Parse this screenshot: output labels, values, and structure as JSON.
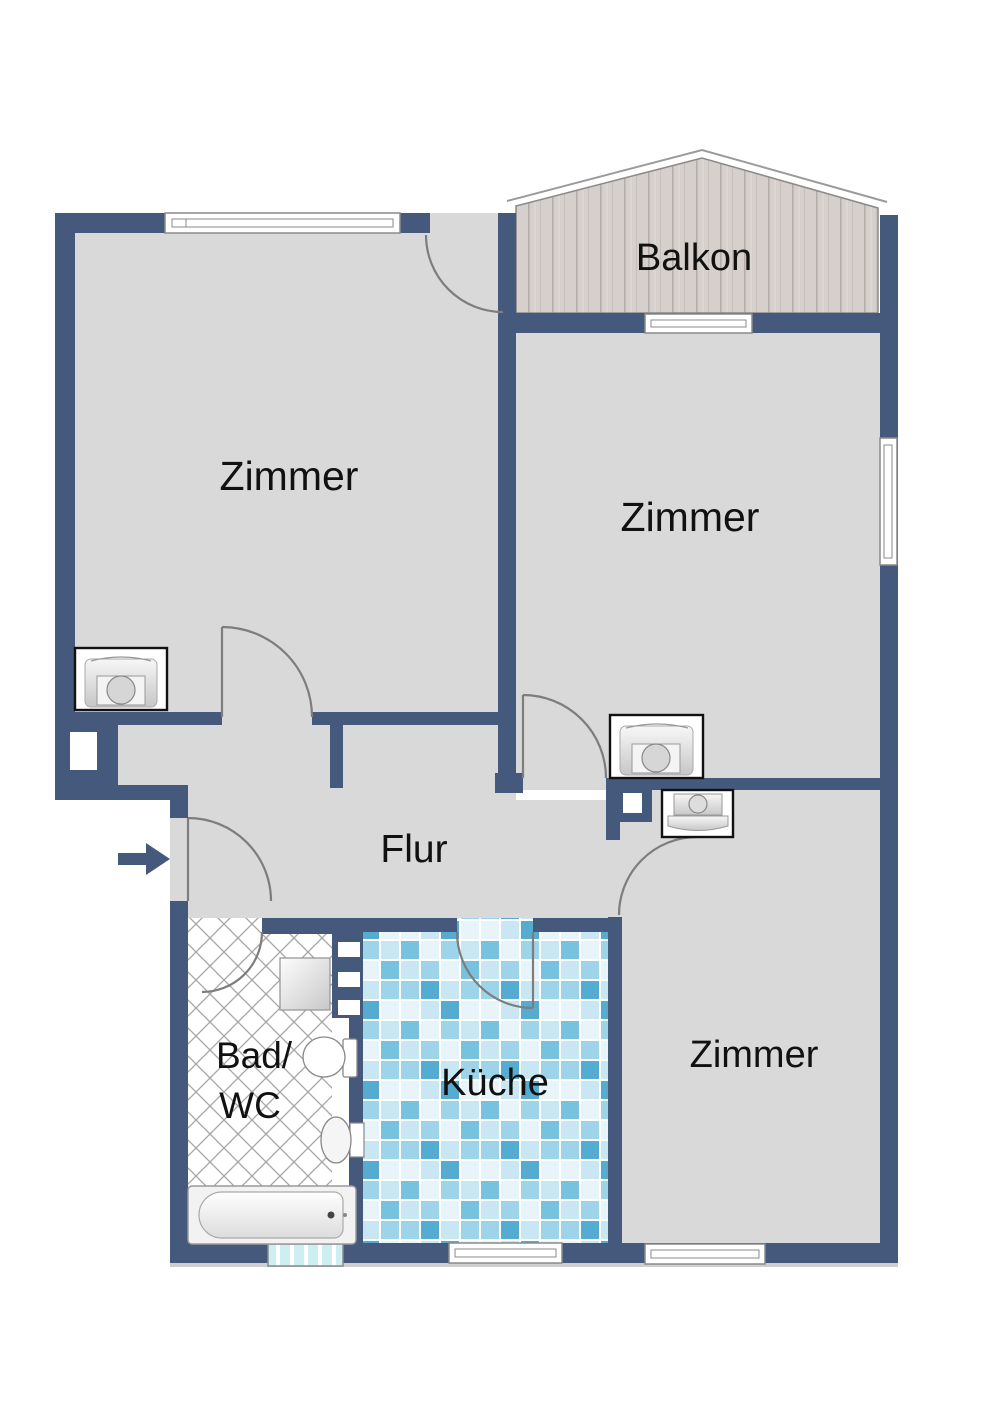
{
  "rooms": {
    "balkon": {
      "label": "Balkon"
    },
    "zimmer_top_left": {
      "label": "Zimmer"
    },
    "zimmer_top_right": {
      "label": "Zimmer"
    },
    "flur": {
      "label": "Flur"
    },
    "bad_wc": {
      "label_line1": "Bad/",
      "label_line2": "WC"
    },
    "kueche": {
      "label": "Küche"
    },
    "zimmer_bottom": {
      "label": "Zimmer"
    }
  },
  "colors": {
    "wall": "#44597c",
    "floor": "#d9d9d9",
    "door_arc": "#7d7d7d",
    "outline": "#8a8a8a",
    "balcony_wood": "#d6d0cd",
    "bad_tile_line": "#a5a5a5",
    "bad_window": "#cdeff2",
    "kitchen_tile_palette": [
      "#e7f4f9",
      "#c9e7f3",
      "#9dd4ea",
      "#77c2de",
      "#55abd0"
    ],
    "window": "#ffffff",
    "label_text": "#111111"
  },
  "icons": {
    "entry_arrow": "entry-direction-arrow",
    "washing_machine_left": "washing-machine",
    "washing_machine_right": "washing-machine",
    "corner_sink": "sink",
    "toilet": "toilet",
    "basin": "wash-basin",
    "shower": "shower-tray",
    "bathtub": "bathtub"
  }
}
